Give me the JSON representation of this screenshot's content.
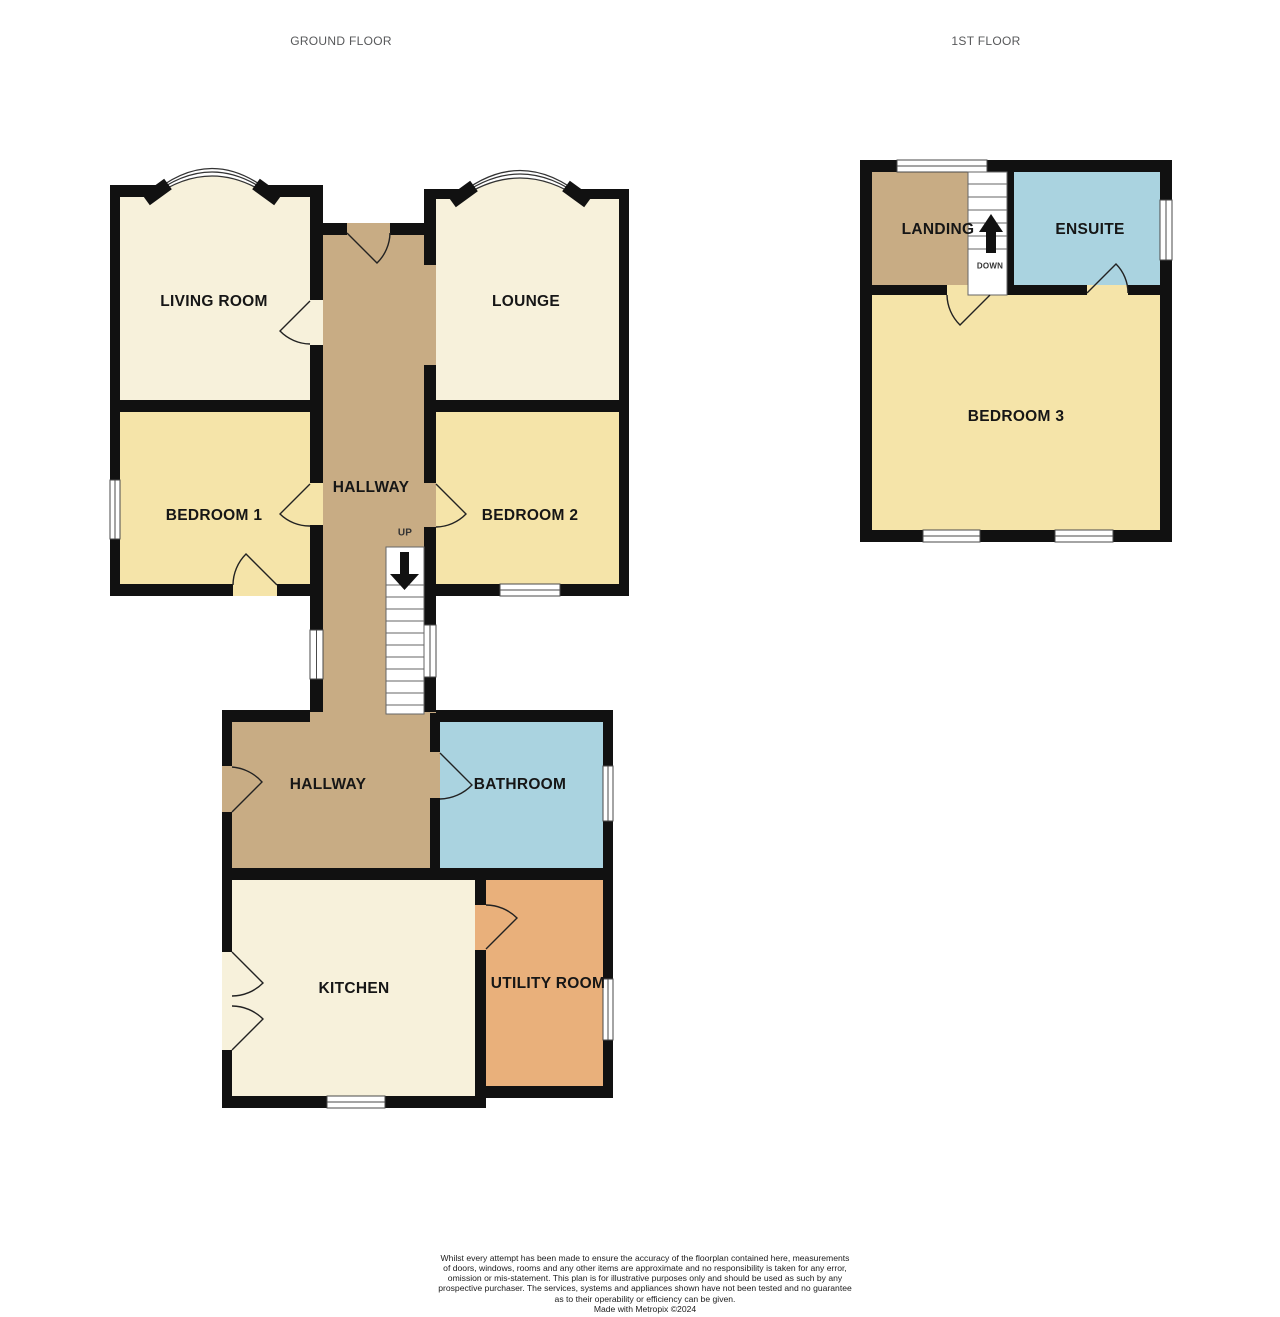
{
  "titles": {
    "ground": "GROUND FLOOR",
    "first": "1ST FLOOR"
  },
  "ground_floor": {
    "living_room": "LIVING ROOM",
    "lounge": "LOUNGE",
    "hallway": "HALLWAY",
    "bedroom_1": "BEDROOM 1",
    "bedroom_2": "BEDROOM 2",
    "stairs_direction": "UP",
    "hallway_lower": "HALLWAY",
    "bathroom": "BATHROOM",
    "kitchen": "KITCHEN",
    "utility_room": "UTILITY ROOM"
  },
  "first_floor": {
    "landing": "LANDING",
    "ensuite": "ENSUITE",
    "stairs_direction": "DOWN",
    "bedroom_3": "BEDROOM 3"
  },
  "colors": {
    "room_cream": "#F7F1DB",
    "room_yellow": "#F5E4A9",
    "hallway_tan": "#C8AC84",
    "bathroom_blue": "#AAD3E0",
    "utility_orange": "#E9B07B",
    "wall": "#111111"
  },
  "footer": {
    "lines": [
      "Whilst every attempt has been made to ensure the accuracy of the floorplan contained here, measurements",
      "of doors, windows, rooms and any other items are approximate and no responsibility is taken for any error,",
      "omission or mis-statement. This plan is for illustrative purposes only and should be used as such by any",
      "prospective purchaser. The services, systems and appliances shown have not been tested and no guarantee",
      "as to their operability or efficiency can be given."
    ],
    "credit": "Made with Metropix ©2024"
  }
}
